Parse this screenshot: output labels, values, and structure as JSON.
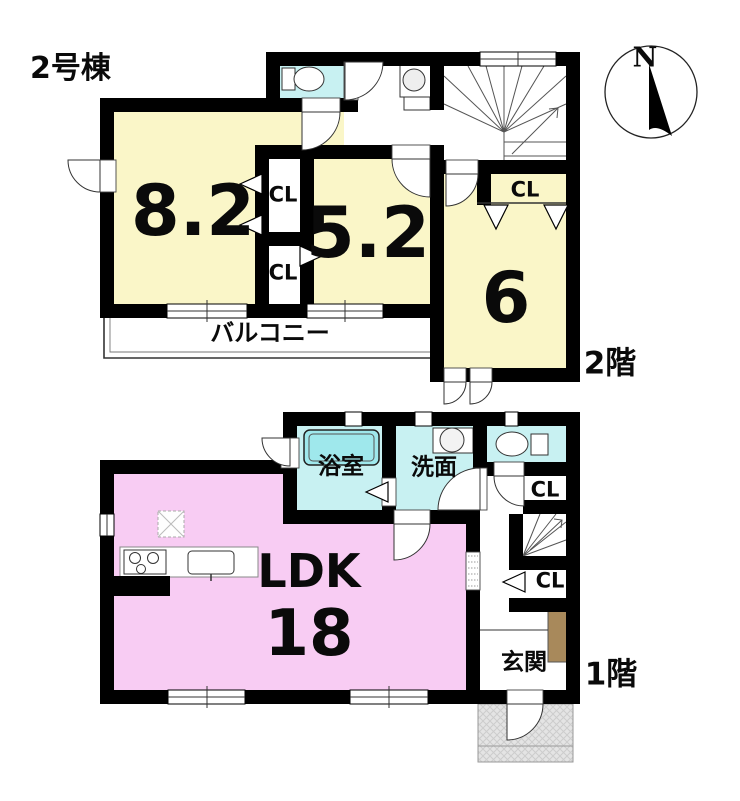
{
  "title": "2号棟",
  "compass": {
    "north_label": "N"
  },
  "colors": {
    "room_yellow": "#FAF6C8",
    "room_pink": "#F8CCF3",
    "water_cyan": "#C8F1F2",
    "bathtub_cyan": "#9FE8EC",
    "wall_black": "#000000",
    "porch_gray": "#E2E2E2",
    "cabinet_brown": "#A8895B"
  },
  "floor2": {
    "floor_label": "2階",
    "rooms": {
      "bedroom_a": {
        "label": "8.2"
      },
      "bedroom_b": {
        "label": "5.2"
      },
      "bedroom_c": {
        "label": "6"
      },
      "closet_a": {
        "label": "CL"
      },
      "closet_b": {
        "label": "CL"
      },
      "closet_c": {
        "label": "CL"
      },
      "balcony": {
        "label": "バルコニー"
      }
    }
  },
  "floor1": {
    "floor_label": "1階",
    "rooms": {
      "ldk": {
        "label": "LDK",
        "size": "18"
      },
      "bathroom": {
        "label": "浴室"
      },
      "washroom": {
        "label": "洗面"
      },
      "entrance": {
        "label": "玄関"
      },
      "closet_hall": {
        "label": "CL"
      },
      "closet_entrance": {
        "label": "CL"
      }
    }
  }
}
